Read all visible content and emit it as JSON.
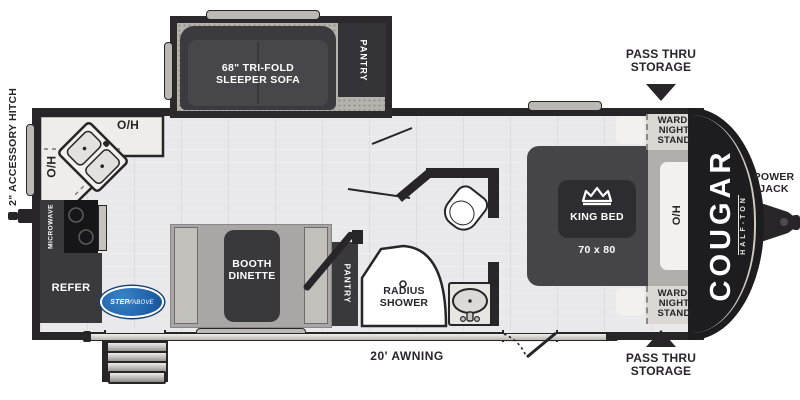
{
  "title": "Cougar Half-Ton travel trailer floor plan",
  "colors": {
    "ink": "#272528",
    "floor": "#e9e9eb",
    "slide_floor": "#b6b3ad",
    "furniture_dark": "#3b3a3e",
    "counter": "#efede9",
    "step_above_blue": "#2166ae"
  },
  "exterior": {
    "accessory_hitch": "2\" ACCESSORY HITCH",
    "pass_thru": "PASS THRU\nSTORAGE",
    "power_jack": "POWER\nJACK",
    "awning": "20' AWNING",
    "brand": "COUGAR",
    "brand_sub": "HALF-TON",
    "step_logo_a": "STEP",
    "step_logo_b": "ABOVE"
  },
  "interior": {
    "sofa": "68\" TRI-FOLD\nSLEEPER SOFA",
    "pantry": "PANTRY",
    "dinette": "BOOTH\nDINETTE",
    "refer": "REFER",
    "microwave": "MICROWAVE",
    "shower": "RADIUS\nSHOWER",
    "king_bed": "KING BED",
    "bed_size": "70 x 80",
    "wardrobe": "WARD.\nNIGHT\nSTAND",
    "overhead": "O/H"
  }
}
